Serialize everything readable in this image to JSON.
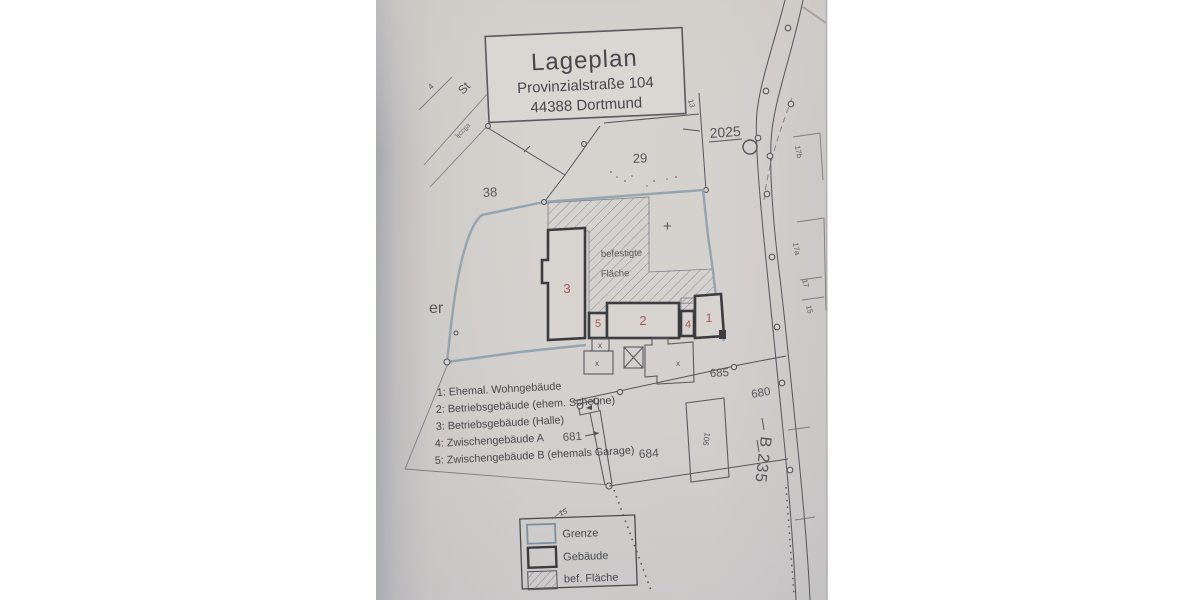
{
  "document": {
    "type_label": "Lageplan",
    "address_line1": "Provinzialstraße 104",
    "address_line2": "44388 Dortmund"
  },
  "key_list": {
    "items": [
      "1: Ehemal. Wohngebäude",
      "2: Betriebsgebäude (ehem. Scheune)",
      "3: Betriebsgebäude (Halle)",
      "4: Zwischengebäude A",
      "5: Zwischengebäude B (ehemals Garage)"
    ]
  },
  "legend_box": {
    "items": [
      {
        "label": "Grenze",
        "swatch": "boundary"
      },
      {
        "label": "Gebäude",
        "swatch": "building"
      },
      {
        "label": "bef. Fläche",
        "swatch": "hatched"
      }
    ]
  },
  "map_labels": {
    "parcel_38": "38",
    "parcel_29": "29",
    "parcel_2025": "2025",
    "parcel_685": "685",
    "parcel_680": "680",
    "parcel_681": "681",
    "parcel_684": "684",
    "road_name": "B 235",
    "surface_line1": "befestigte",
    "surface_line2": "Fläche",
    "house_17b": "17b",
    "house_17a": "17a",
    "house_17": "17",
    "house_15": "15",
    "house_13": "13",
    "house_106": "106",
    "street_fragment_st": "St",
    "street_fragment_er": "er",
    "small_4": "4",
    "tick_15": "15",
    "illegible_road_text": "ɐſʇɔɔʇʅ"
  },
  "building_numbers": {
    "b1": "1",
    "b2": "2",
    "b3": "3",
    "b4": "4",
    "b5": "5"
  },
  "symbols": {
    "x_mark": "x",
    "plus_mark": "+"
  },
  "colors": {
    "paper": "#d5d2ce",
    "paper_edge_shadow": "#aaabb4",
    "ink": "#55555a",
    "building_ink": "#3b3b40",
    "boundary_blue": "#90a2b0",
    "building_number_red": "#a8565a",
    "background": "#ffffff"
  }
}
